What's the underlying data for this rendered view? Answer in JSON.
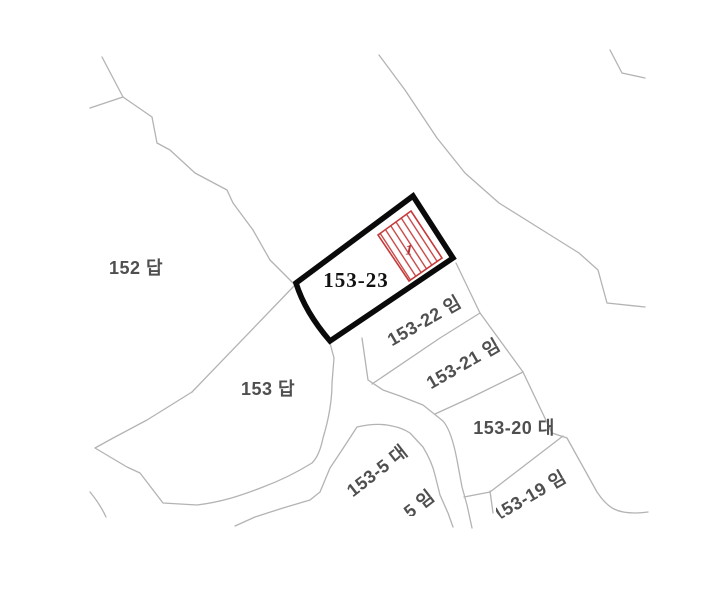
{
  "background_color": "#ffffff",
  "colors": {
    "boundary_line": "#b3b3b3",
    "highlight_outline": "#0a0a0a",
    "hatch_red": "#c43b3b",
    "label_gray": "#4f4f4f",
    "subject_label": "#111111",
    "red_label": "#b23030"
  },
  "parcels": {
    "p152": {
      "label": "152 답"
    },
    "p153": {
      "label": "153 답"
    },
    "p153_23": {
      "label": "153-23",
      "inner_mark": "1"
    },
    "p153_22": {
      "label": "153-22 임"
    },
    "p153_21": {
      "label": "153-21 임"
    },
    "p153_20": {
      "label": "153-20 대"
    },
    "p153_5": {
      "label": "153-5 대"
    },
    "p153_19": {
      "label": "153-19 임"
    },
    "p_partial": {
      "label": "5 임"
    }
  }
}
